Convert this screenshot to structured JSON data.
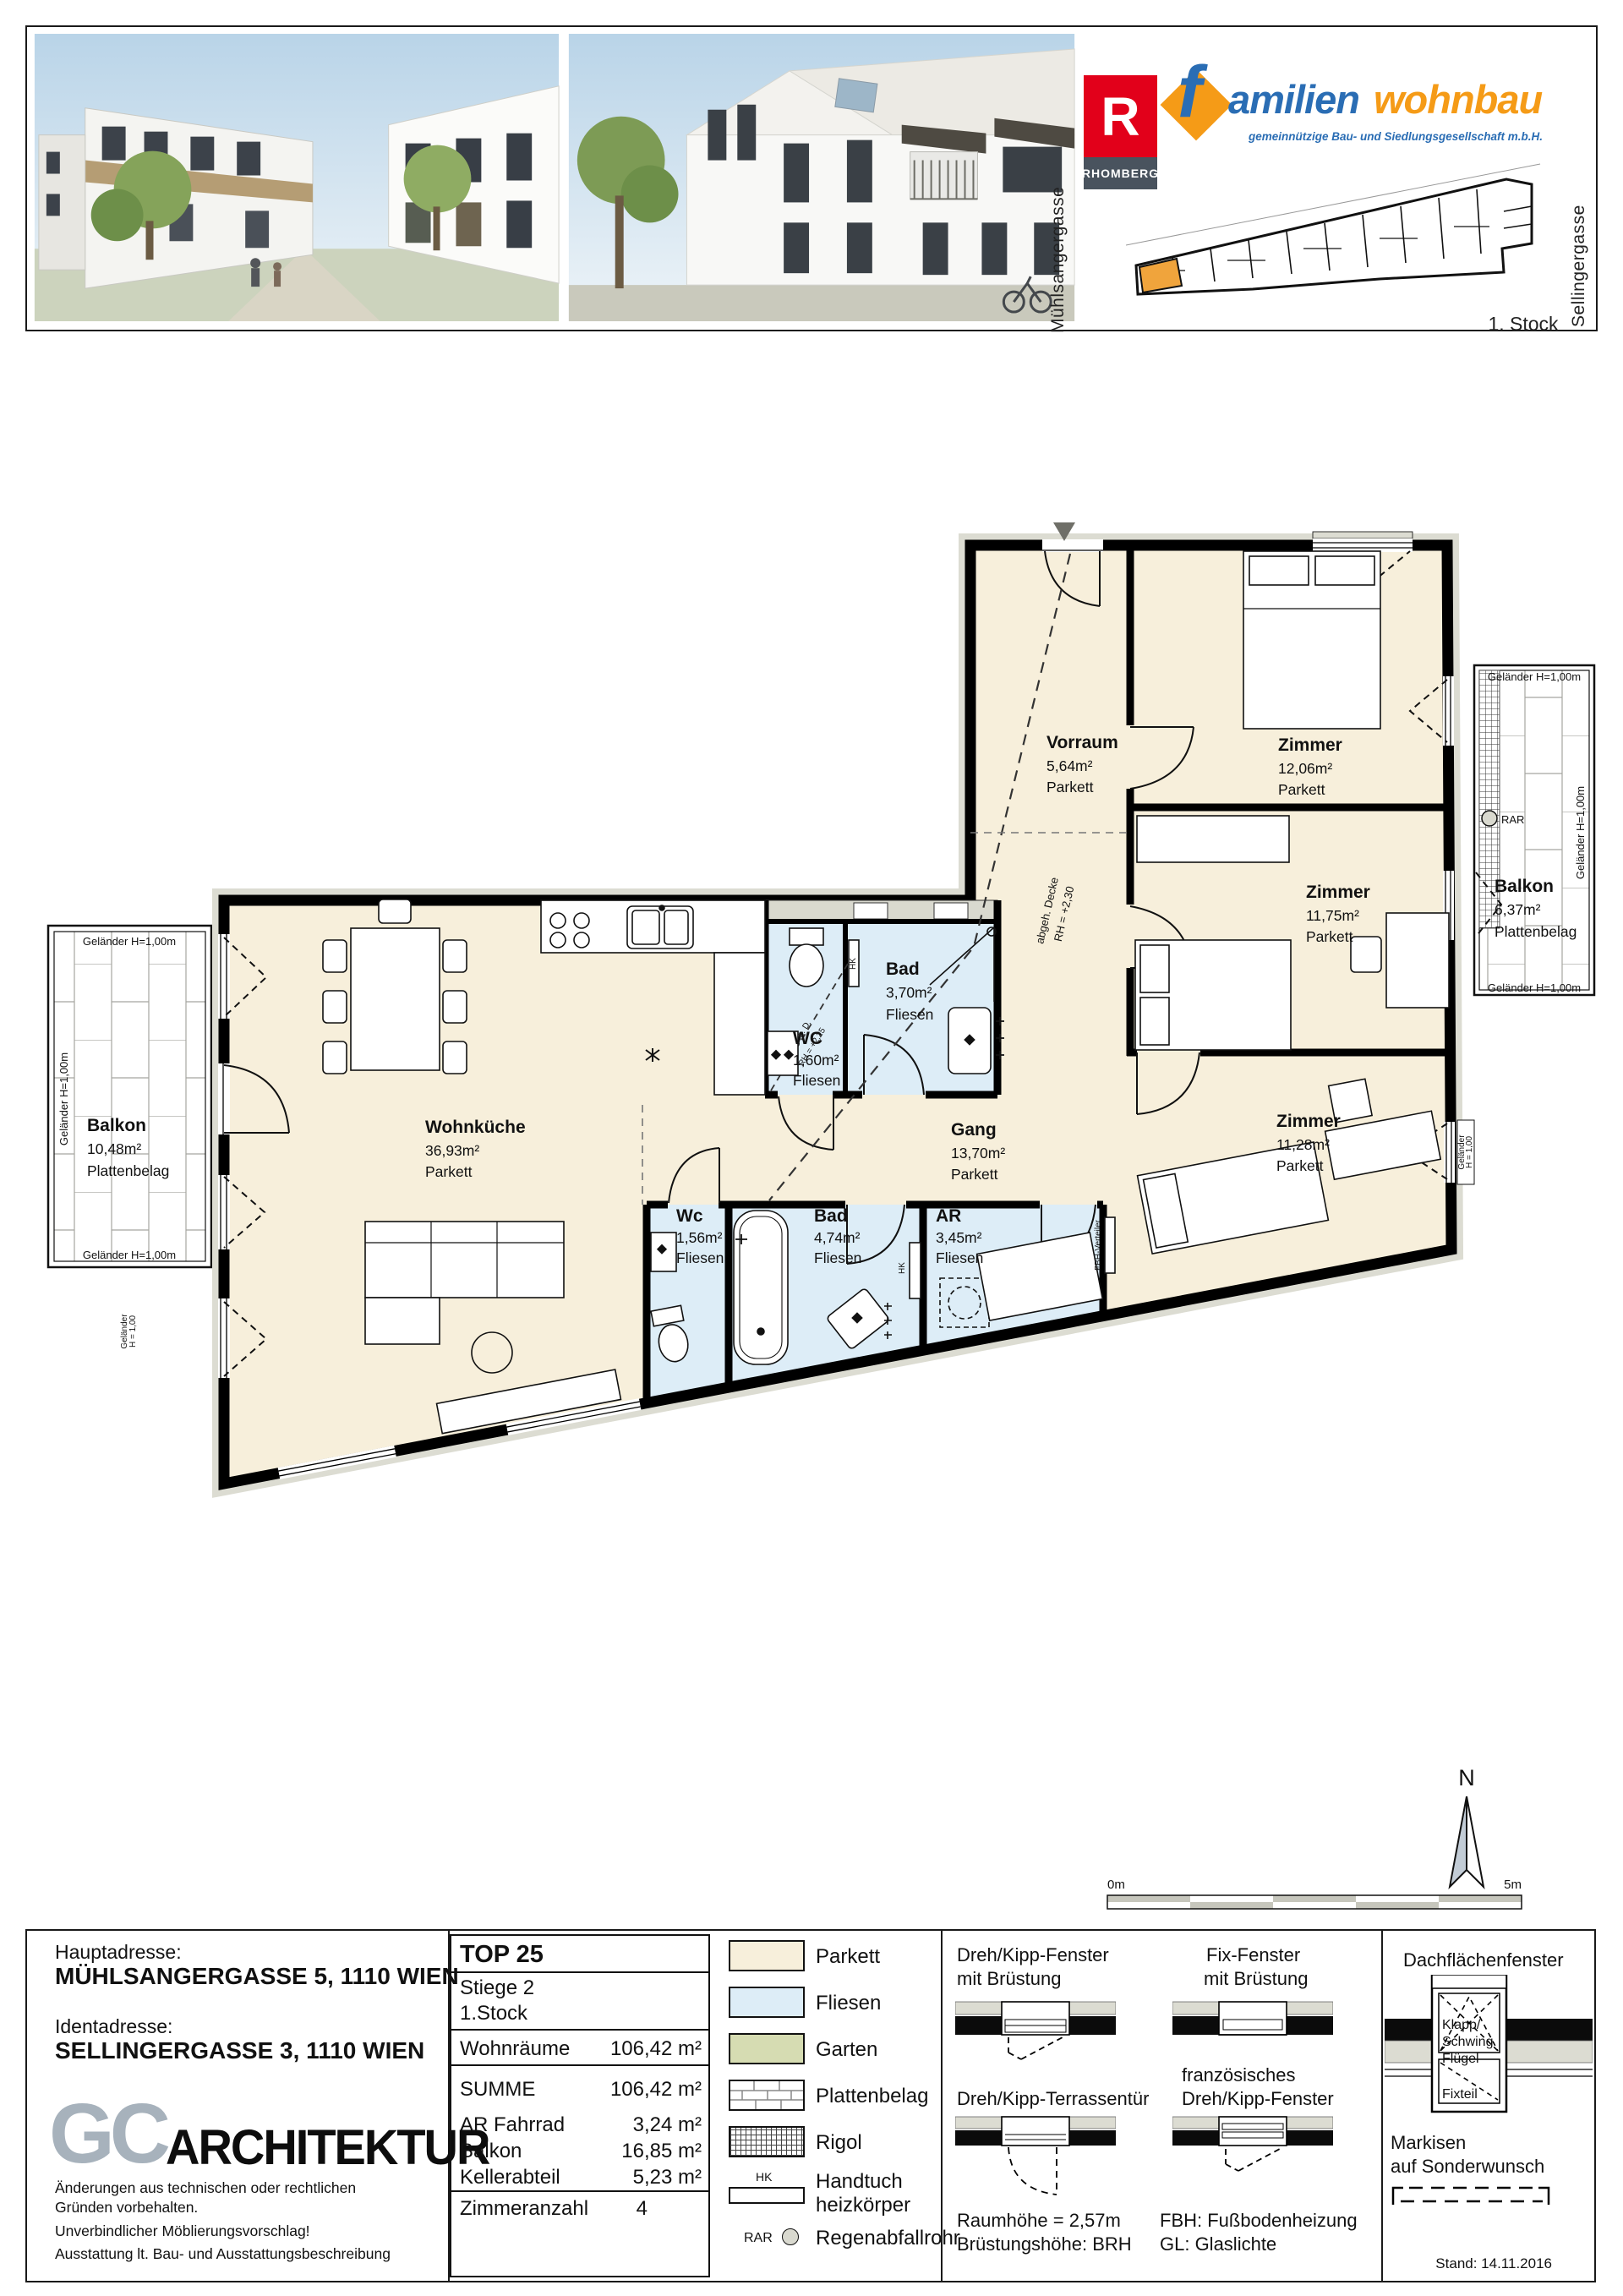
{
  "colors": {
    "parkett": "#f7efdb",
    "fliesen": "#ddedf7",
    "garten": "#d6dcb2",
    "wall_grey": "#dcdcd2",
    "brand_red": "#e2001a",
    "brand_slate": "#49535e",
    "brand_orange": "#f59b17",
    "brand_blue": "#2a6db4",
    "logo_grey": "#a7b2bc",
    "north_fill": "#c2ccd6"
  },
  "header": {
    "street_left": "Mühlsangergasse",
    "street_right": "Sellingergasse",
    "floor_label": "1. Stock",
    "rhomberg_letter": "R",
    "rhomberg_name": "RHOMBERG",
    "fwb_f": "f",
    "fwb_part1": "amilien",
    "fwb_part2": "wohnbau",
    "fwb_subtitle": "gemeinnützige Bau- und Siedlungsgesellschaft m.b.H."
  },
  "plan": {
    "rooms": {
      "vorraum": {
        "name": "Vorraum",
        "area": "5,64m²",
        "floor": "Parkett"
      },
      "zimmer1": {
        "name": "Zimmer",
        "area": "12,06m²",
        "floor": "Parkett"
      },
      "zimmer2": {
        "name": "Zimmer",
        "area": "11,75m²",
        "floor": "Parkett"
      },
      "zimmer3": {
        "name": "Zimmer",
        "area": "11,28m²",
        "floor": "Parkett"
      },
      "wohnkueche": {
        "name": "Wohnküche",
        "area": "36,93m²",
        "floor": "Parkett"
      },
      "gang": {
        "name": "Gang",
        "area": "13,70m²",
        "floor": "Parkett"
      },
      "bad_klein": {
        "name": "Bad",
        "area": "3,70m²",
        "floor": "Fliesen"
      },
      "wc_gross": {
        "name": "WC",
        "area": "1,60m²",
        "floor": "Fliesen"
      },
      "wc_klein": {
        "name": "Wc",
        "area": "1,56m²",
        "floor": "Fliesen"
      },
      "bad_gross": {
        "name": "Bad",
        "area": "4,74m²",
        "floor": "Fliesen"
      },
      "abstellraum": {
        "name": "AR",
        "area": "3,45m²",
        "floor": "Fliesen"
      },
      "balkon_links": {
        "name": "Balkon",
        "area": "10,48m²",
        "floor": "Plattenbelag"
      },
      "balkon_rechts": {
        "name": "Balkon",
        "area": "6,37m²",
        "floor": "Plattenbelag"
      }
    },
    "ann": {
      "gelaender": "Geländer H=1,00m",
      "gelaender_kurz": "Geländer",
      "gelaender_h": "H = 1,00",
      "abgeh_decke": "abgeh. Decke",
      "rh_230": "RH = +2,30",
      "abgeh_d": "abgeh. D.",
      "rh_225": "RH = +2,25",
      "fbh": "FBH-Verteiler",
      "hk": "HK",
      "rar": "RAR",
      "north": "N",
      "scale_0": "0m",
      "scale_5": "5m"
    }
  },
  "titleblock": {
    "haupt_label": "Hauptadresse:",
    "haupt_value": "MÜHLSANGERGASSE 5, 1110 WIEN",
    "ident_label": "Identadresse:",
    "ident_value": "SELLINGERGASSE 3, 1110 WIEN",
    "logo_gc": "GC",
    "logo_arch": "ARCHITEKTUR",
    "disclaimer1": "Änderungen aus technischen oder rechtlichen",
    "disclaimer2": "Gründen vorbehalten.",
    "disclaimer3": "Unverbindlicher Möblierungsvorschlag!",
    "disclaimer4": "Ausstattung lt. Bau- und Ausstattungsbeschreibung",
    "top": "TOP 25",
    "stiege": "Stiege 2",
    "stock": "1.Stock",
    "wohnraeume_label": "Wohnräume",
    "wohnraeume_value": "106,42 m²",
    "summe_label": "SUMME",
    "summe_value": "106,42 m²",
    "ar_label": "AR Fahrrad",
    "ar_value": "3,24 m²",
    "balkon_label": "Balkon",
    "balkon_value": "16,85 m²",
    "keller_label": "Kellerabteil",
    "keller_value": "5,23 m²",
    "zimmer_label": "Zimmeranzahl",
    "zimmer_value": "4",
    "stand": "Stand: 14.11.2016"
  },
  "legend": {
    "parkett": "Parkett",
    "fliesen": "Fliesen",
    "garten": "Garten",
    "plattenbelag": "Plattenbelag",
    "rigol": "Rigol",
    "hk": "HK",
    "handtuch1": "Handtuch",
    "handtuch2": "heizkörper",
    "rar": "RAR",
    "regenabfallrohr": "Regenabfallrohr"
  },
  "win": {
    "dk1": "Dreh/Kipp-Fenster",
    "dk2": "mit Brüstung",
    "fix1": "Fix-Fenster",
    "fix2": "mit Brüstung",
    "dach": "Dachflächenfenster",
    "terr": "Dreh/Kipp-Terrassentür",
    "fr1": "französisches",
    "fr2": "Dreh/Kipp-Fenster",
    "raum": "Raumhöhe = 2,57m",
    "brh": "Brüstungshöhe: BRH",
    "fbh": "FBH: Fußbodenheizung",
    "gl": "GL: Glaslichte",
    "mark1": "Markisen",
    "mark2": "auf Sonderwunsch",
    "klapp1": "Klapp/",
    "klapp2": "Schwing",
    "klapp3": "Flügel",
    "fixteil": "Fixteil"
  }
}
